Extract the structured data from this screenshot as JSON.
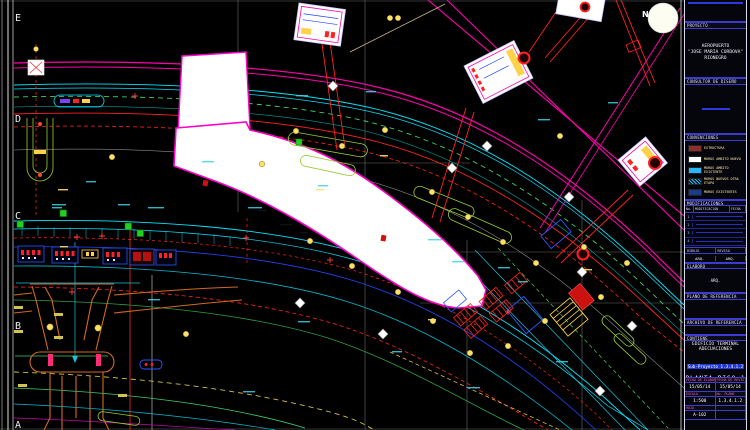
{
  "drawing": {
    "north_label": "N",
    "grid_rows": [
      {
        "label": "E"
      },
      {
        "label": "D"
      },
      {
        "label": "C"
      },
      {
        "label": "B"
      },
      {
        "label": "A"
      }
    ],
    "colors": {
      "background": "#000000",
      "walls_accent": "#ff00c8",
      "circulation": "#00e5ff",
      "structure_red": "#ff2222",
      "landscape_green": "#9acd32",
      "road_orange": "#d2691e",
      "column_yellow": "#ffe066"
    }
  },
  "title_block": {
    "project_header": "PROYECTO",
    "project_name_line1": "AEROPUERTO",
    "project_name_line2": "\"JOSE MARIA CORDOVA\"",
    "project_name_line3": "RIONEGRO",
    "consultant_header": "CONSULTOR DE DISEÑO",
    "legend_header": "CONVENCIONES",
    "legend": [
      {
        "label": "ESTRUCTURA",
        "color": "#8b2e2e"
      },
      {
        "label": "MUROS AMBITO NUEVO",
        "color": "#ffffff"
      },
      {
        "label": "MUROS AMBITO EXISTENTE",
        "color": "#29b6f6"
      },
      {
        "label": "MUROS NUEVOS OTRA ETAPA",
        "color": "hatch"
      },
      {
        "label": "MUROS EXISTENTES",
        "color": "#1a3a8a"
      }
    ],
    "revisions_header": "MODIFICACIONES",
    "revisions_columns": [
      "No.",
      "MODIFICACION",
      "FECHA"
    ],
    "revisions": [
      {
        "no": "1"
      },
      {
        "no": "2"
      },
      {
        "no": "3"
      },
      {
        "no": "4"
      },
      {
        "no": "5"
      }
    ],
    "drawn_label": "DIBUJO",
    "review_label": "REVISO",
    "drawn_value": "ARQ.",
    "review_value": "ARQ.",
    "elaborated_header": "ELABORO",
    "elaborated_value": "ARQ.",
    "reference_plan_header": "PLANO DE REFERENCIA",
    "reference_file_header": "ARCHIVO DE REFERENCIA",
    "contains_header": "CONTIENE",
    "building_line1": "EDIFICIO TERMINAL",
    "building_line2": "ADECUACIONES",
    "subproject": "Sub-Proyecto 1.3.4.1.2",
    "sheet_title": "PLANTA PISO 1",
    "meta": {
      "date_label": "FECHA DE ELABORACION",
      "date_value": "15/05/14",
      "date2_label": "FECHA DE REVISION",
      "date2_value": "15/05/14",
      "scale_label": "ESCALA",
      "scale_value": "1:500",
      "plan_label": "No. PLANO",
      "plan_value": "1.3.4.1.2",
      "sheet_label": "HOJA",
      "sheet_value": "A-102"
    }
  }
}
